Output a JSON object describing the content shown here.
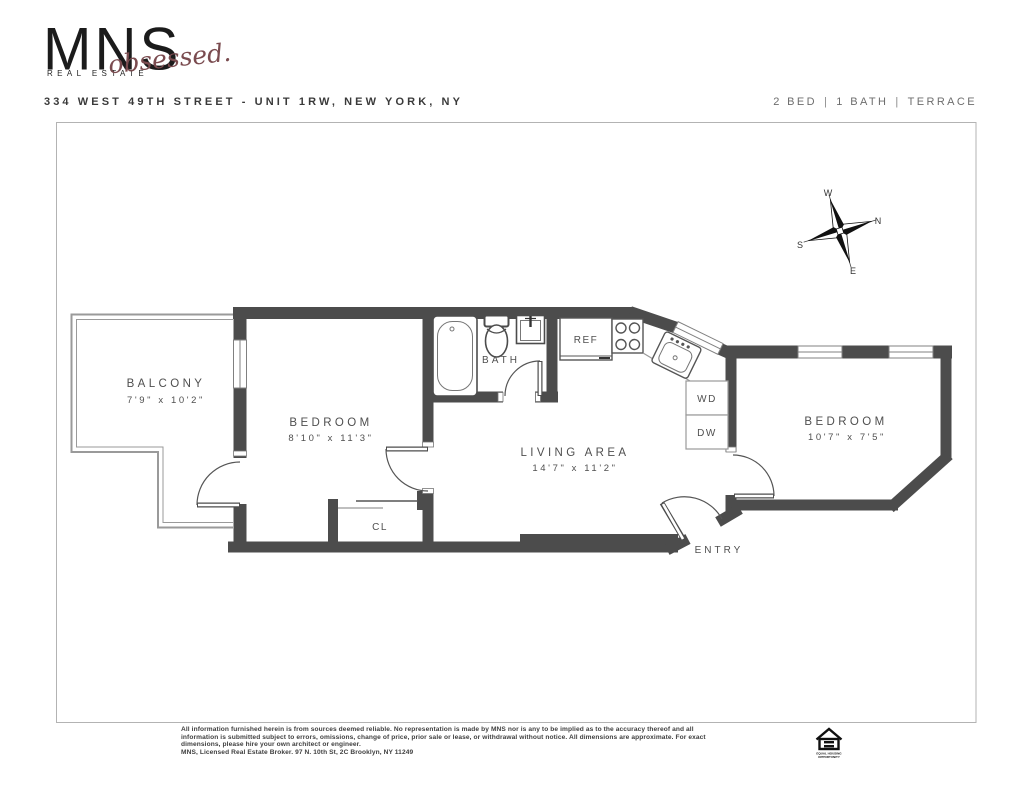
{
  "header": {
    "brand": {
      "name": "MNS",
      "subtitle": "REAL ESTATE",
      "script": "obsessed."
    },
    "address": "334 WEST 49TH STREET - UNIT 1RW, NEW YORK, NY",
    "summary": {
      "beds": "2 BED",
      "baths": "1 BATH",
      "extra": "TERRACE",
      "separator": "|"
    }
  },
  "compass": {
    "west": "W",
    "north": "N",
    "south": "S",
    "east": "E"
  },
  "floorplan": {
    "balcony": {
      "name": "BALCONY",
      "dims": "7'9\" x 10'2\""
    },
    "bedroom1": {
      "name": "BEDROOM",
      "dims": "8'10\" x 11'3\""
    },
    "bath": {
      "name": "BATH"
    },
    "living": {
      "name": "LIVING AREA",
      "dims": "14'7\" x 11'2\""
    },
    "bedroom2": {
      "name": "BEDROOM",
      "dims": "10'7\" x 7'5\""
    },
    "entry": {
      "name": "ENTRY"
    },
    "closet": {
      "name": "CL"
    },
    "appliances": {
      "fridge": "REF",
      "washer_dryer": "WD",
      "dishwasher": "DW"
    }
  },
  "colors": {
    "wall": "#4c4c4c",
    "label": "#4f4f4f",
    "script_accent": "#7a4b4f",
    "border": "#b3b3b3"
  },
  "footer": {
    "disclaimer_lines": [
      "All information furnished herein is from sources deemed reliable. No representation is made by MNS nor is any to be implied as to the accuracy thereof and all",
      "information is submitted subject to errors, omissions, change of price, prior sale or lease, or withdrawal without notice. All dimensions are approximate. For exact",
      "dimensions, please hire your own architect or engineer.",
      "MNS, Licensed Real Estate Broker. 97 N. 10th St, 2C Brooklyn, NY 11249"
    ],
    "eho": {
      "line1": "EQUAL HOUSING",
      "line2": "OPPORTUNITY"
    }
  }
}
